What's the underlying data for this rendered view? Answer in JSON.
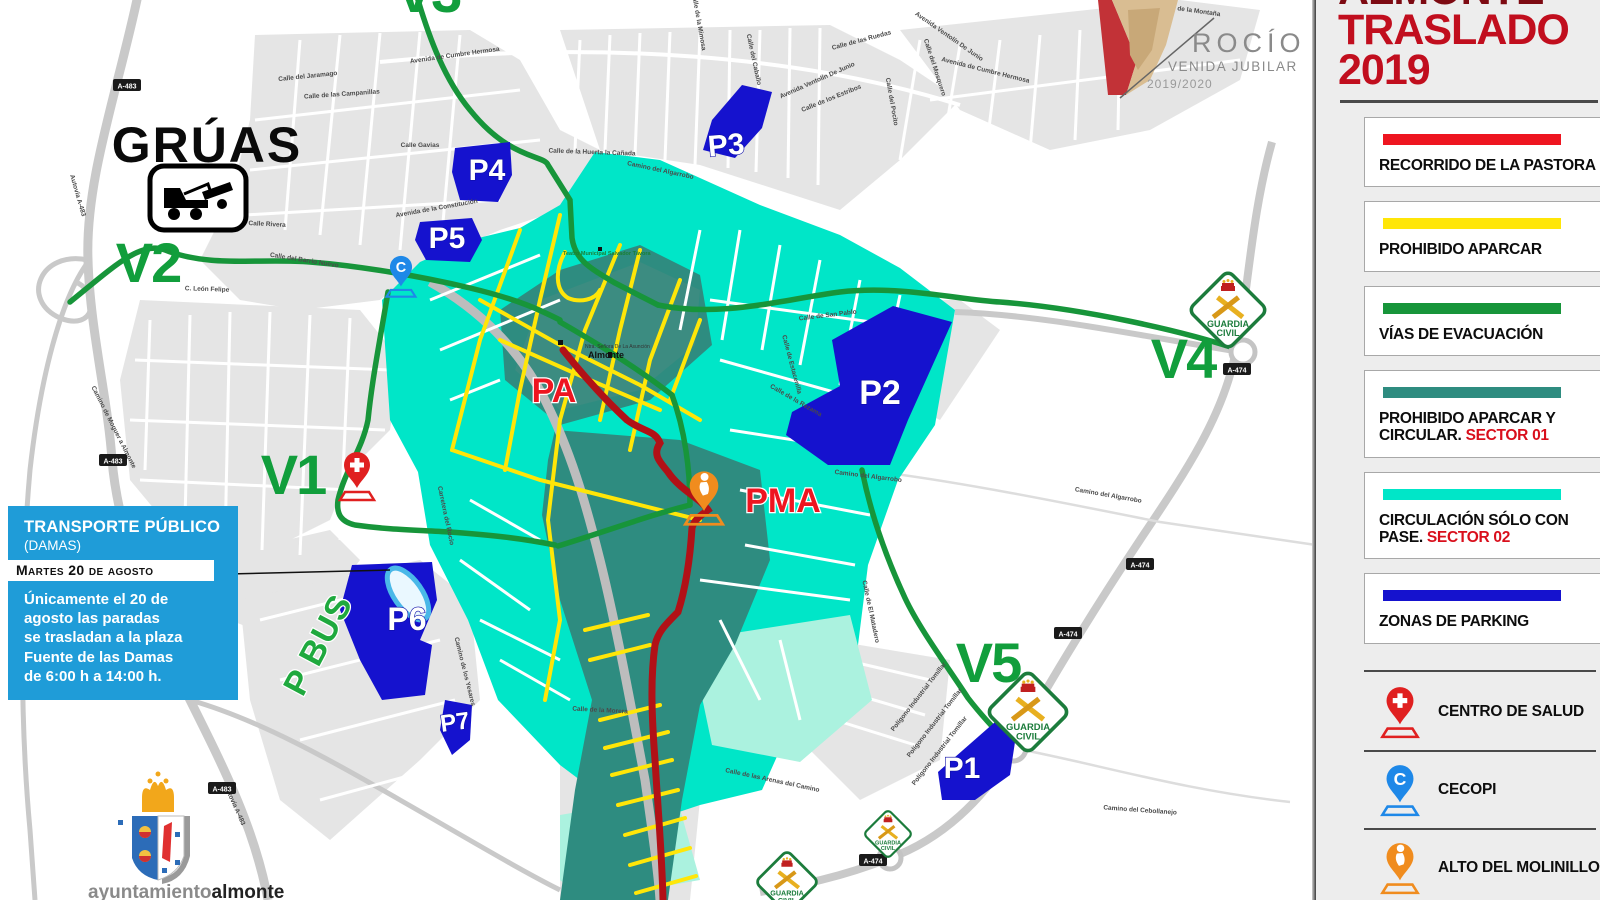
{
  "colors": {
    "sector02_cyan": "#00e6c8",
    "sector01_teal": "#2e8c80",
    "pale_cyan": "#abf2df",
    "parking_blue": "#1512ce",
    "evac_green": "#17953a",
    "street_yellow": "#ffe608",
    "route_red": "#b11117",
    "label_red": "#ee1520",
    "v_green": "#119e3c",
    "title_dark": "#7d0a12",
    "title_red": "#c10e1e",
    "transport_blue": "#1f9cd8",
    "pin_red": "#e02020",
    "pin_blue": "#1e88e8",
    "pin_orange": "#f08c1e",
    "guardia_green": "#1c7c3c"
  },
  "panel": {
    "title_line1": "ALMONTE",
    "title_line2": "TRASLADO",
    "title_line3": "2019",
    "legend": [
      {
        "label": "RECORRIDO DE LA PASTORA",
        "swatch": "#ee1520"
      },
      {
        "label": "PROHIBIDO APARCAR",
        "swatch": "#ffe608"
      },
      {
        "label": "VÍAS DE EVACUACIÓN",
        "swatch": "#17953a"
      },
      {
        "label": "PROHIBIDO APARCAR Y  CIRCULAR.",
        "label_red": "SECTOR 01",
        "swatch": "#2e8c80"
      },
      {
        "label": "CIRCULACIÓN SÓLO CON PASE.",
        "label_red": "SECTOR 02",
        "swatch": "#00e6c8"
      },
      {
        "label": "ZONAS DE PARKING",
        "swatch": "#1512ce"
      }
    ],
    "markers": [
      {
        "icon": "health-pin",
        "label": "CENTRO DE SALUD",
        "color": "#e02020"
      },
      {
        "icon": "cecopi-pin",
        "label": "CECOPI",
        "color": "#1e88e8",
        "glyph": "C"
      },
      {
        "icon": "molinillo-pin",
        "label": "ALTO DEL MOLINILLO",
        "color": "#f08c1e"
      }
    ]
  },
  "logo": {
    "title": "ROCÍO",
    "subtitle": "VENIDA JUBILAR",
    "season": "2019/2020"
  },
  "gruas_label": "GRÚAS",
  "transport_box": {
    "title": "TRANSPORTE PÚBLICO",
    "subtitle": "(DAMAS)",
    "date": "Martes 20 de agosto",
    "body": "Únicamente el 20 de\nagosto las paradas\nse trasladan a la plaza\nFuente de las Damas\nde 6:00 h a 14:00 h."
  },
  "footer_logo": {
    "normal": "ayuntamiento",
    "bold": "almonte"
  },
  "map": {
    "guardia": {
      "line1": "GUARDIA",
      "line2": "CIVIL"
    },
    "pa_label": "PA",
    "pma_label": "PMA",
    "pbus_label": "P BUS",
    "town_label": "Almonte",
    "church_label": "Ntra. Señora De La Asunción",
    "theatre_label": "Teatro Municipal Salvador Távora",
    "v_labels": [
      {
        "t": "V1",
        "x": 293,
        "y": 474
      },
      {
        "t": "V2",
        "x": 148,
        "y": 262
      },
      {
        "t": "V3",
        "x": 428,
        "y": -8
      },
      {
        "t": "V4",
        "x": 1183,
        "y": 358
      },
      {
        "t": "V5",
        "x": 988,
        "y": 662
      }
    ],
    "parkings": [
      {
        "t": "P1",
        "x": 962,
        "y": 778,
        "s": 30
      },
      {
        "t": "P2",
        "x": 880,
        "y": 404,
        "s": 34
      },
      {
        "t": "P3",
        "x": 727,
        "y": 155,
        "s": 30,
        "r": -5
      },
      {
        "t": "P4",
        "x": 487,
        "y": 180,
        "s": 30
      },
      {
        "t": "P5",
        "x": 447,
        "y": 248,
        "s": 30
      },
      {
        "t": "P6",
        "x": 407,
        "y": 630,
        "s": 32
      },
      {
        "t": "P7",
        "x": 456,
        "y": 730,
        "s": 24,
        "r": -8
      }
    ],
    "road_shields": [
      {
        "t": "A-483",
        "x": 127,
        "y": 87
      },
      {
        "t": "A-483",
        "x": 113,
        "y": 462
      },
      {
        "t": "A-483",
        "x": 222,
        "y": 790
      },
      {
        "t": "A-474",
        "x": 1237,
        "y": 371
      },
      {
        "t": "A-474",
        "x": 1140,
        "y": 566
      },
      {
        "t": "A-474",
        "x": 1068,
        "y": 635
      },
      {
        "t": "A-474",
        "x": 873,
        "y": 862
      }
    ],
    "street_labels": [
      {
        "t": "Avenida de Cumbre Hermosa",
        "x": 455,
        "y": 57,
        "r": -8
      },
      {
        "t": "Avenida de Cumbre Hermosa",
        "x": 985,
        "y": 72,
        "r": 14
      },
      {
        "t": "Calle de la Montaña",
        "x": 1190,
        "y": 12,
        "r": 8
      },
      {
        "t": "Calle del Caballo",
        "x": 752,
        "y": 60,
        "r": 78
      },
      {
        "t": "Avenida Ventolín De Junio",
        "x": 818,
        "y": 82,
        "r": -24
      },
      {
        "t": "Avenida Ventolín De Junio",
        "x": 948,
        "y": 38,
        "r": 35
      },
      {
        "t": "Calle de los Estribos",
        "x": 832,
        "y": 100,
        "r": -22
      },
      {
        "t": "Calle del Pocito",
        "x": 890,
        "y": 102,
        "r": 80
      },
      {
        "t": "Calle del Mosquero",
        "x": 933,
        "y": 68,
        "r": 72
      },
      {
        "t": "Calle de las Ruedas",
        "x": 862,
        "y": 42,
        "r": -15
      },
      {
        "t": "Calle de la Mimosa",
        "x": 697,
        "y": 22,
        "r": 80
      },
      {
        "t": "Calle de la Huerta la Cañada",
        "x": 592,
        "y": 154,
        "r": 2
      },
      {
        "t": "Camino del Algarrobo",
        "x": 660,
        "y": 172,
        "r": 12
      },
      {
        "t": "Calle de San Pablo",
        "x": 828,
        "y": 317,
        "r": -7
      },
      {
        "t": "Calle del Barrio Nuevo",
        "x": 304,
        "y": 262,
        "r": 9
      },
      {
        "t": "Avenida de la Constitución",
        "x": 437,
        "y": 210,
        "r": -10
      },
      {
        "t": "Calle Rivera",
        "x": 267,
        "y": 226,
        "r": 3
      },
      {
        "t": "Calle Gavias",
        "x": 420,
        "y": 147,
        "r": 0
      },
      {
        "t": "Calle del Jaramago",
        "x": 308,
        "y": 78,
        "r": -6
      },
      {
        "t": "Calle de las Campanillas",
        "x": 342,
        "y": 96,
        "r": -4
      },
      {
        "t": "C. León Felipe",
        "x": 207,
        "y": 291,
        "r": 2
      },
      {
        "t": "Autovía A-483",
        "x": 76,
        "y": 196,
        "r": 74
      },
      {
        "t": "Autovía A-483",
        "x": 233,
        "y": 806,
        "r": 66
      },
      {
        "t": "Avenida de los Cabezudos",
        "x": 40,
        "y": 648,
        "r": 72
      },
      {
        "t": "Camino de Moguer a Almonte",
        "x": 112,
        "y": 428,
        "r": 63
      },
      {
        "t": "Polígono Industrial Tomillar",
        "x": 920,
        "y": 698,
        "r": -52
      },
      {
        "t": "Polígono Industrial Tomillar",
        "x": 936,
        "y": 724,
        "r": -52
      },
      {
        "t": "Polígono Industrial Tomillar",
        "x": 941,
        "y": 752,
        "r": -52
      },
      {
        "t": "Carretera del Rocío",
        "x": 444,
        "y": 516,
        "r": 78
      },
      {
        "t": "Camino del Algarrobo",
        "x": 868,
        "y": 478,
        "r": 7
      },
      {
        "t": "Camino del Algarrobo",
        "x": 1108,
        "y": 497,
        "r": 10
      },
      {
        "t": "Camino del Cebollanejo",
        "x": 1140,
        "y": 812,
        "r": 4
      },
      {
        "t": "Camino de los Yesares",
        "x": 463,
        "y": 672,
        "r": 76
      },
      {
        "t": "Calle de El Matadero",
        "x": 869,
        "y": 612,
        "r": 78
      },
      {
        "t": "Calle de la Morera",
        "x": 600,
        "y": 712,
        "r": 3
      },
      {
        "t": "Calle de las Arenas del Camino",
        "x": 772,
        "y": 782,
        "r": 12
      },
      {
        "t": "Calle de Estacenilla",
        "x": 790,
        "y": 365,
        "r": 75
      },
      {
        "t": "Calle de la Rezama",
        "x": 795,
        "y": 402,
        "r": 30
      }
    ]
  }
}
